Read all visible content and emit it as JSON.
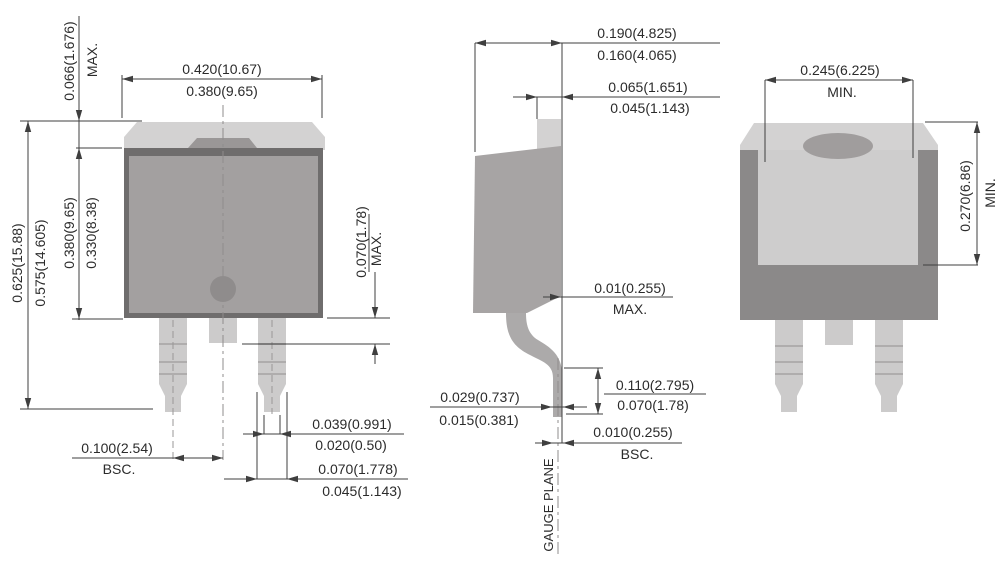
{
  "drawing": {
    "views": {
      "front": {
        "labels": {
          "tab_height_max": "0.066(1.676)",
          "tab_height_qual": "MAX.",
          "width_max": "0.420(10.67)",
          "width_min": "0.380(9.65)",
          "total_height_max": "0.625(15.88)",
          "total_height_min": "0.575(14.605)",
          "body_height_max": "0.380(9.65)",
          "body_height_min": "0.330(8.38)",
          "center_lead_max": "0.070(1.78)",
          "center_lead_qual": "MAX.",
          "pitch": "0.100(2.54)",
          "pitch_qual": "BSC.",
          "tip_width_max": "0.039(0.991)",
          "tip_width_min": "0.020(0.50)",
          "lead_width_max": "0.070(1.778)",
          "lead_width_min": "0.045(1.143)"
        }
      },
      "side": {
        "labels": {
          "depth_max": "0.190(4.825)",
          "depth_min": "0.160(4.065)",
          "tab_thickness_max": "0.065(1.651)",
          "tab_thickness_min": "0.045(1.143)",
          "body_setback": "0.01(0.255)",
          "body_setback_qual": "MAX.",
          "lead_height_max": "0.110(2.795)",
          "lead_height_min": "0.070(1.78)",
          "lead_thickness_max": "0.029(0.737)",
          "lead_thickness_min": "0.015(0.381)",
          "gauge_offset": "0.010(0.255)",
          "gauge_offset_qual": "BSC.",
          "gauge_plane": "GAUGE PLANE"
        }
      },
      "back": {
        "labels": {
          "pad_width_min": "0.245(6.225)",
          "pad_width_qual": "MIN.",
          "pad_height_min": "0.270(6.86)",
          "pad_height_qual": "MIN."
        }
      }
    },
    "colors": {
      "background": "#ffffff",
      "tab_light": "#d3d2d2",
      "body_fill": "#a3a0a0",
      "body_border": "#6f6d6d",
      "bump": "#9a9797",
      "lead": "#cccbcb",
      "side_body": "#a7a4a4",
      "side_lead": "#acaaaa",
      "back_body": "#8b8989",
      "back_panel": "#cecdcd",
      "oval_hole": "#a09d9d",
      "dimple": "#8f8c8c",
      "line": "#3f3f3f",
      "text": "#2b2b2b"
    }
  }
}
